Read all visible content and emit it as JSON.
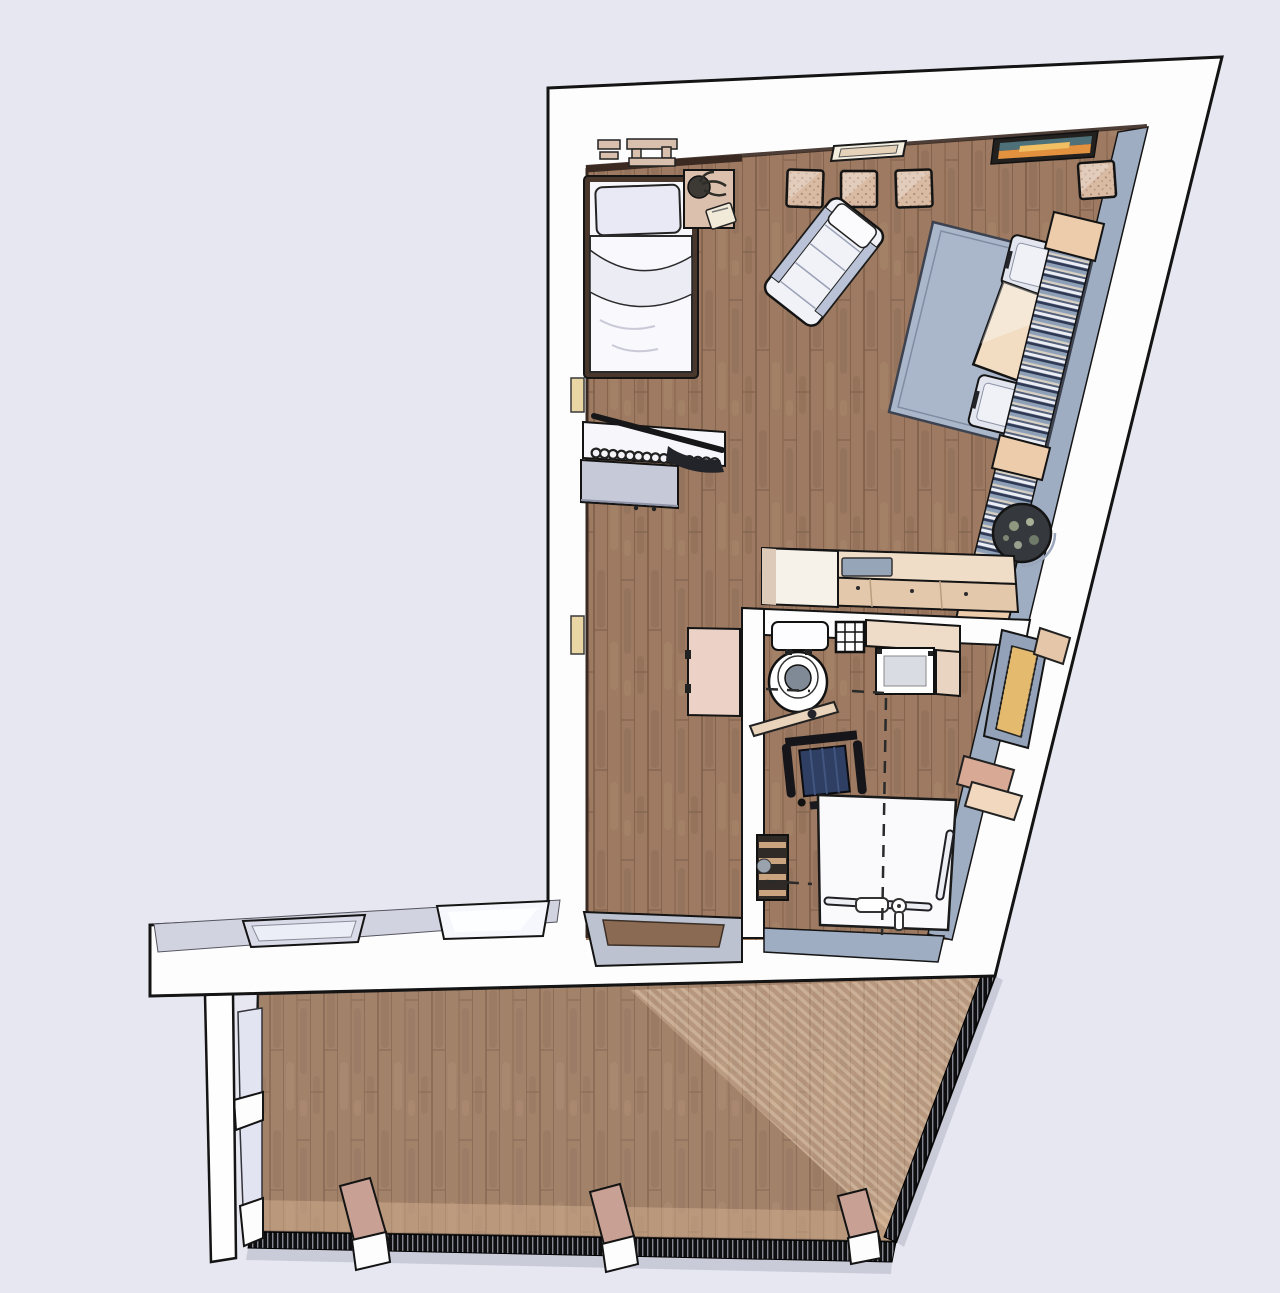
{
  "meta": {
    "description": "3D top-down perspective rendering of a studio apartment floor plan with a large wooden terrace",
    "view": "perspective-top-down",
    "text_visible": false
  },
  "palette": {
    "background": "#e6e7f0",
    "wall": "#fdfdfe",
    "outline": "#141414",
    "wall_top": "#d2d3e0",
    "wall_face": "#9fadc2",
    "floor": "#9d7a61",
    "floor_line": "#85644d",
    "deck_light": "#d8b492",
    "rug": "#aab7cb",
    "rug_border": "#3c4250",
    "table": "#f2dcc2",
    "counter": "#f0ddc8",
    "counter_dark": "#e3c8ac",
    "linen": "#f6f6fb",
    "pouf": "#d9bba4",
    "pouf_dot": "#a5826b",
    "books_dark": "#2e3a55",
    "gold": "#e4ba6e",
    "navy": "#2e3f63",
    "shower": "#fafafc",
    "railing": "#0e0e10",
    "post": "#c8a094",
    "glass": "#e3e4f2",
    "trim": "#3a2a22",
    "threshold": "#bcc2cf",
    "blue_inset": "#97a5b8"
  },
  "rooms": [
    {
      "id": "living-bedroom"
    },
    {
      "id": "hallway"
    },
    {
      "id": "bathroom"
    },
    {
      "id": "terrace"
    }
  ],
  "counts": {
    "poufs": 4,
    "dining_chairs": 2,
    "deck_posts": 3,
    "south_windows": 2,
    "bookshelf_blocks": 3
  },
  "labels": {
    "scene": "3D floor plan rendering",
    "walls": "apartment walls",
    "floor": "wood plank floor",
    "bed": "single bed with pillow and duvet",
    "nightstand": "nightstand with plant and book",
    "pouf": "square floor pouf",
    "lounge": "reclined lounge chair",
    "rug": "blue-gray area rug",
    "table": "square wooden dining table",
    "chair": "dining chair cushion",
    "bookshelf": "wall bookshelf with books",
    "pot": "round floor plant pot",
    "counter": "kitchen counter with sink",
    "wardrobe": "open clothes rail with hangers",
    "dresser": "gray dresser",
    "niche": "wall niche",
    "desk": "hallway side table",
    "bathroom": "bathroom",
    "toilet": "toilet",
    "grid": "wall grid shelf",
    "vanity": "vanity counter",
    "basin": "washbasin unit",
    "wheelchair": "wheelchair",
    "grabwood": "wooden grab rail",
    "shower": "walk-in shower floor",
    "grabbar": "shower grab bar",
    "fixture": "shower fixture",
    "shelf": "bathroom shelf unit",
    "radiator": "towel radiator",
    "bench": "wall bench",
    "threshold": "terrace door threshold",
    "window": "window opening",
    "deck": "terrace wood deck",
    "railing": "terrace railing",
    "postlabel": "wooden deck post",
    "glasswall": "terrace glass side wall",
    "art": "wall artwork",
    "wallwindow": "wall window slit",
    "wallitems": "wall-mounted shelves"
  }
}
